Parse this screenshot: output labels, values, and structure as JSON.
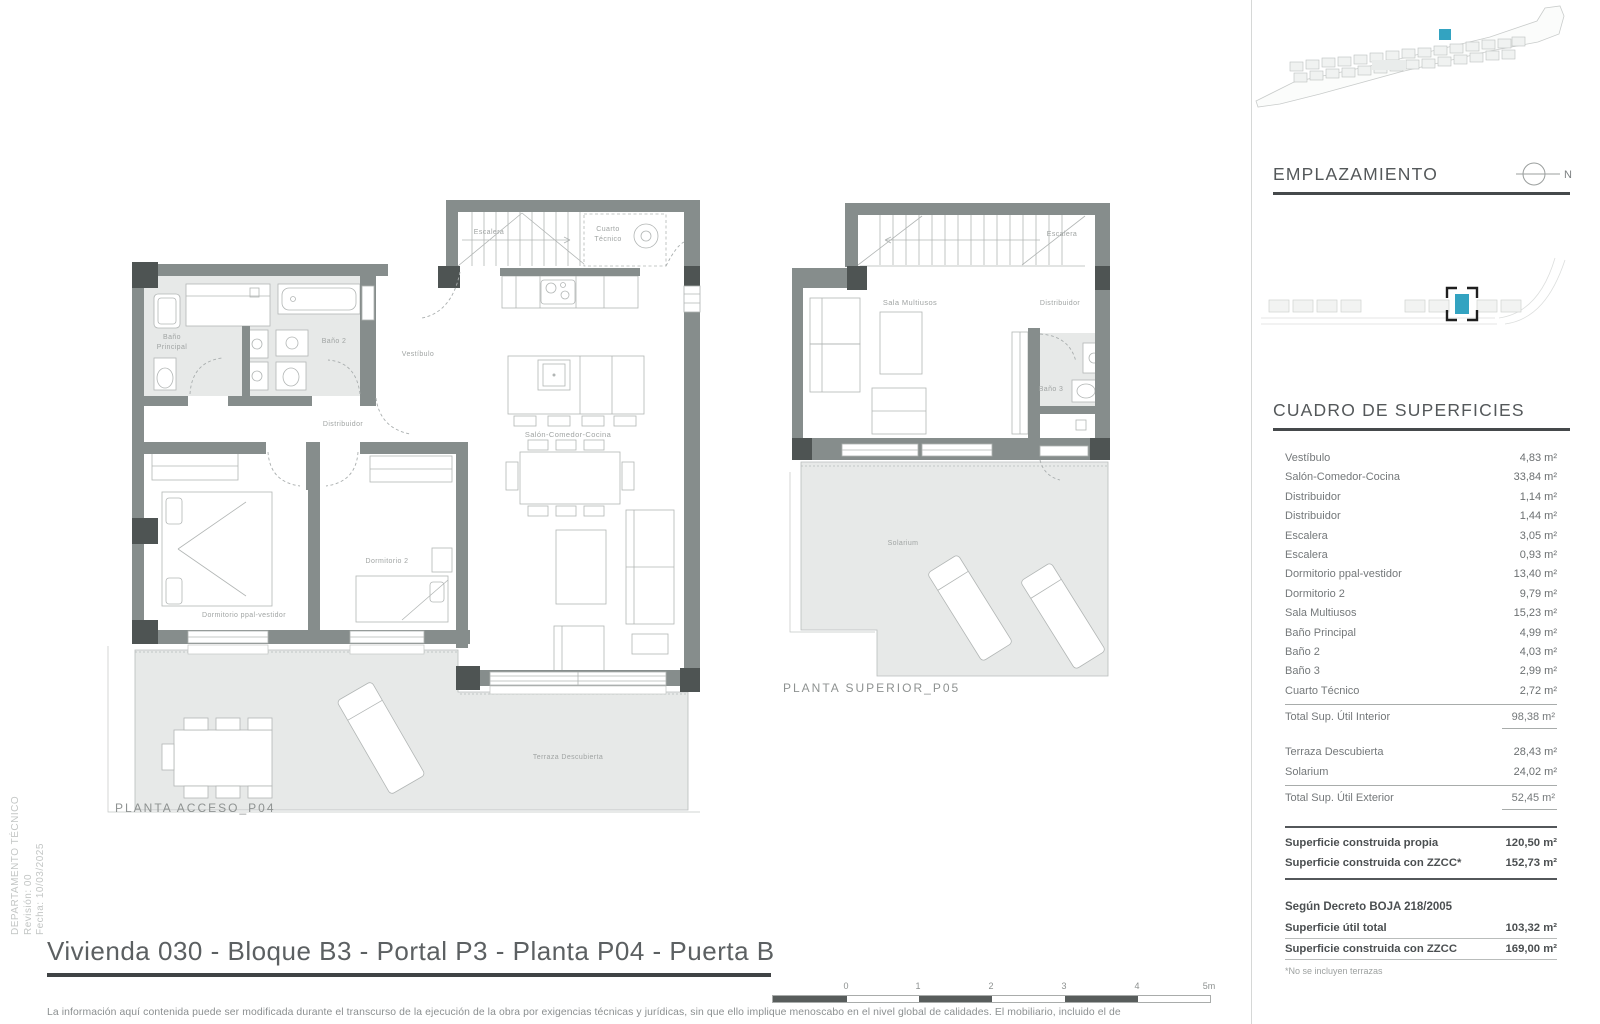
{
  "colors": {
    "teal": "#33a3c1",
    "wall": "#868d8c",
    "pillar": "#4e5453",
    "floor": "#e7e9e8",
    "accent": "#45494b"
  },
  "sidebar": {
    "department": "DEPARTAMENTO TÉCNICO",
    "revision": "Revisión: 00",
    "date": "Fecha: 10/03/2025"
  },
  "site": {
    "title": "EMPLAZAMIENTO",
    "north": "N"
  },
  "surfaces": {
    "title": "CUADRO DE SUPERFICIES",
    "rows": [
      {
        "label": "Vestíbulo",
        "value": "4,83 m²"
      },
      {
        "label": "Salón-Comedor-Cocina",
        "value": "33,84 m²"
      },
      {
        "label": "Distribuidor",
        "value": "1,14 m²"
      },
      {
        "label": "Distribuidor",
        "value": "1,44 m²"
      },
      {
        "label": "Escalera",
        "value": "3,05 m²"
      },
      {
        "label": "Escalera",
        "value": "0,93 m²"
      },
      {
        "label": "Dormitorio ppal-vestidor",
        "value": "13,40 m²"
      },
      {
        "label": "Dormitorio 2",
        "value": "9,79 m²"
      },
      {
        "label": "Sala Multiusos",
        "value": "15,23 m²"
      },
      {
        "label": "Baño Principal",
        "value": "4,99 m²"
      },
      {
        "label": "Baño 2",
        "value": "4,03 m²"
      },
      {
        "label": "Baño 3",
        "value": "2,99 m²"
      },
      {
        "label": "Cuarto Técnico",
        "value": "2,72 m²"
      }
    ],
    "total_interior": {
      "label": "Total Sup. Útil Interior",
      "value": "98,38 m²"
    },
    "exterior_rows": [
      {
        "label": "Terraza Descubierta",
        "value": "28,43 m²"
      },
      {
        "label": "Solarium",
        "value": "24,02 m²"
      }
    ],
    "total_exterior": {
      "label": "Total Sup. Útil Exterior",
      "value": "52,45 m²"
    },
    "built_rows": [
      {
        "label": "Superficie construida propia",
        "value": "120,50 m²"
      },
      {
        "label": "Superficie construida con ZZCC*",
        "value": "152,73 m²"
      }
    ],
    "decree_heading": "Según Decreto BOJA 218/2005",
    "decree_rows": [
      {
        "label": "Superficie útil total",
        "value": "103,32 m²"
      },
      {
        "label": "Superficie construida con ZZCC",
        "value": "169,00 m²"
      }
    ],
    "footnote": "*No se incluyen terrazas"
  },
  "plan_access": {
    "caption": "PLANTA ACCESO_P04",
    "rooms": {
      "escalera": "Escalera",
      "cuarto_l1": "Cuarto",
      "cuarto_l2": "Técnico",
      "vestibulo": "Vestíbulo",
      "bano_ppal_l1": "Baño",
      "bano_ppal_l2": "Principal",
      "bano2": "Baño 2",
      "distribuidor": "Distribuidor",
      "salon": "Salón-Comedor-Cocina",
      "dorm_ppal": "Dormitorio ppal-vestidor",
      "dorm2": "Dormitorio 2",
      "terraza": "Terraza Descubierta"
    }
  },
  "plan_upper": {
    "caption": "PLANTA SUPERIOR_P05",
    "rooms": {
      "escalera": "Escalera",
      "sala": "Sala Multiusos",
      "distribuidor": "Distribuidor",
      "bano3": "Baño 3",
      "solarium": "Solarium"
    }
  },
  "footer": {
    "title": "Vivienda 030 - Bloque B3 - Portal P3 - Planta P04 - Puerta B",
    "disclaimer": "La información aquí contenida puede ser modificada durante el transcurso de la ejecución de la obra por exigencias técnicas y jurídicas, sin que ello implique menoscabo en el nivel global de calidades. El mobiliario, incluido el de",
    "scale_ticks": [
      "0",
      "1",
      "2",
      "3",
      "4",
      "5m"
    ]
  }
}
